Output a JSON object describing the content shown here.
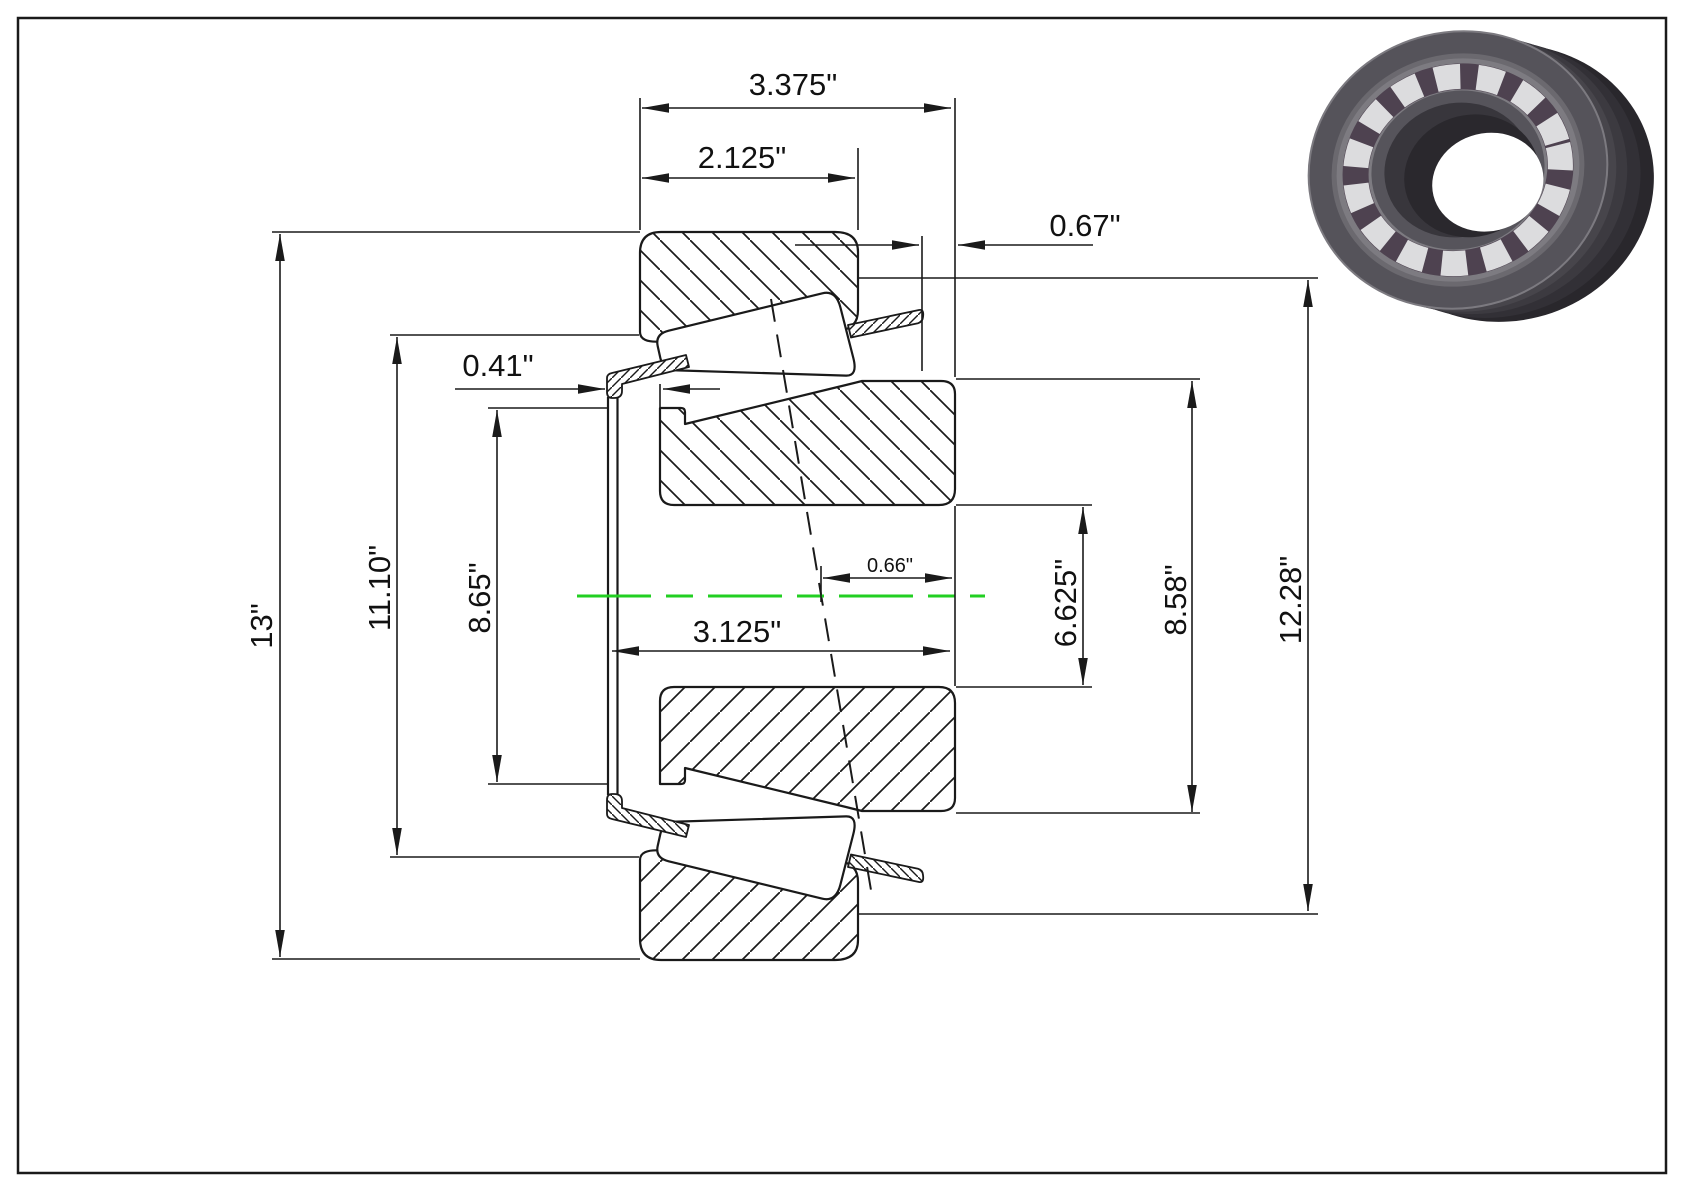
{
  "drawing": {
    "description": "Tapered roller bearing cross-section technical drawing",
    "colors": {
      "line": "#1a1a1a",
      "centerline_green": "#22cf22",
      "background": "#ffffff"
    },
    "dimensions": {
      "overall_width": "3.375\"",
      "cup_width": "2.125\"",
      "standout_right": "0.67\"",
      "standout_left": "0.41\"",
      "housing_diameter": "13\"",
      "flange_diameter": "11.10\"",
      "front_rib_diameter": "8.65\"",
      "effective_load_center": "0.66\"",
      "cone_width": "3.125\"",
      "bore_diameter": "6.625\"",
      "back_rib_diameter": "8.58\"",
      "cup_outer_diameter": "12.28\""
    },
    "thumbnail": {
      "name": "bearing-3d-render"
    }
  }
}
